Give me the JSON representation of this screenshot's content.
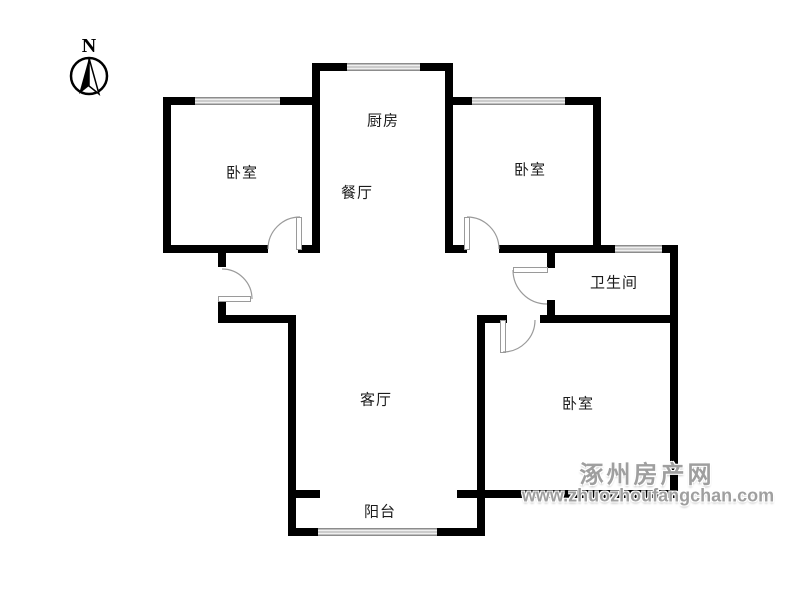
{
  "compass": {
    "label": "N"
  },
  "rooms": [
    {
      "id": "kitchen",
      "label": "厨房",
      "x": 383,
      "y": 120
    },
    {
      "id": "dining-room",
      "label": "餐厅",
      "x": 357,
      "y": 192
    },
    {
      "id": "bedroom-top-left",
      "label": "卧室",
      "x": 242,
      "y": 172
    },
    {
      "id": "bedroom-top-right",
      "label": "卧室",
      "x": 530,
      "y": 169
    },
    {
      "id": "bathroom",
      "label": "卫生间",
      "x": 614,
      "y": 282
    },
    {
      "id": "bedroom-bottom-right",
      "label": "卧室",
      "x": 578,
      "y": 403
    },
    {
      "id": "living-room",
      "label": "客厅",
      "x": 376,
      "y": 399
    },
    {
      "id": "balcony",
      "label": "阳台",
      "x": 380,
      "y": 511
    }
  ],
  "watermark": {
    "title": "涿州房产网",
    "url": "www.zhuozhoufangchan.com",
    "title_x": 647,
    "title_y": 472,
    "url_x": 648,
    "url_y": 496,
    "color": "#9f9f9f"
  },
  "floorplan": {
    "wall_color": "#000000",
    "door_color": "#9a9a9a",
    "walls": [
      [
        312,
        63,
        141,
        8
      ],
      [
        312,
        63,
        8,
        190
      ],
      [
        163,
        97,
        157,
        8
      ],
      [
        163,
        97,
        8,
        156
      ],
      [
        163,
        245,
        105,
        8
      ],
      [
        298,
        245,
        22,
        8
      ],
      [
        445,
        70,
        8,
        183
      ],
      [
        445,
        97,
        156,
        8
      ],
      [
        593,
        97,
        8,
        156
      ],
      [
        445,
        245,
        22,
        8
      ],
      [
        499,
        245,
        179,
        8
      ],
      [
        670,
        245,
        8,
        253
      ],
      [
        547,
        253,
        8,
        15
      ],
      [
        547,
        300,
        8,
        23
      ],
      [
        485,
        315,
        22,
        8
      ],
      [
        540,
        315,
        138,
        8
      ],
      [
        218,
        253,
        8,
        14
      ],
      [
        218,
        299,
        8,
        24
      ],
      [
        218,
        315,
        75,
        8
      ],
      [
        288,
        315,
        8,
        221
      ],
      [
        477,
        315,
        8,
        221
      ],
      [
        293,
        490,
        27,
        8
      ],
      [
        457,
        490,
        221,
        8
      ],
      [
        288,
        528,
        197,
        8
      ]
    ],
    "windows": [
      [
        195,
        97,
        85,
        8
      ],
      [
        347,
        63,
        73,
        8
      ],
      [
        472,
        97,
        93,
        8
      ],
      [
        615,
        245,
        47,
        8
      ],
      [
        318,
        528,
        119,
        8
      ]
    ],
    "doors": [
      {
        "name": "bedroom-top-left-door",
        "leaf": [
          296,
          217,
          6,
          33
        ],
        "arc": "M 268 249 A 32 32 0 0 1 300 217"
      },
      {
        "name": "entry-door",
        "leaf": [
          218,
          296,
          33,
          6
        ],
        "arc": "M 222 269 A 30 30 0 0 1 252 299"
      },
      {
        "name": "bedroom-top-right-door",
        "leaf": [
          464,
          217,
          6,
          33
        ],
        "arc": "M 467 217 A 32 32 0 0 1 499 249"
      },
      {
        "name": "bathroom-door",
        "leaf": [
          513,
          267,
          35,
          6
        ],
        "arc": "M 513 270 A 34 34 0 0 0 547 304"
      },
      {
        "name": "bedroom-bottom-right-door",
        "leaf": [
          500,
          320,
          6,
          33
        ],
        "arc": "M 503 352 A 32 32 0 0 0 535 320"
      }
    ]
  }
}
